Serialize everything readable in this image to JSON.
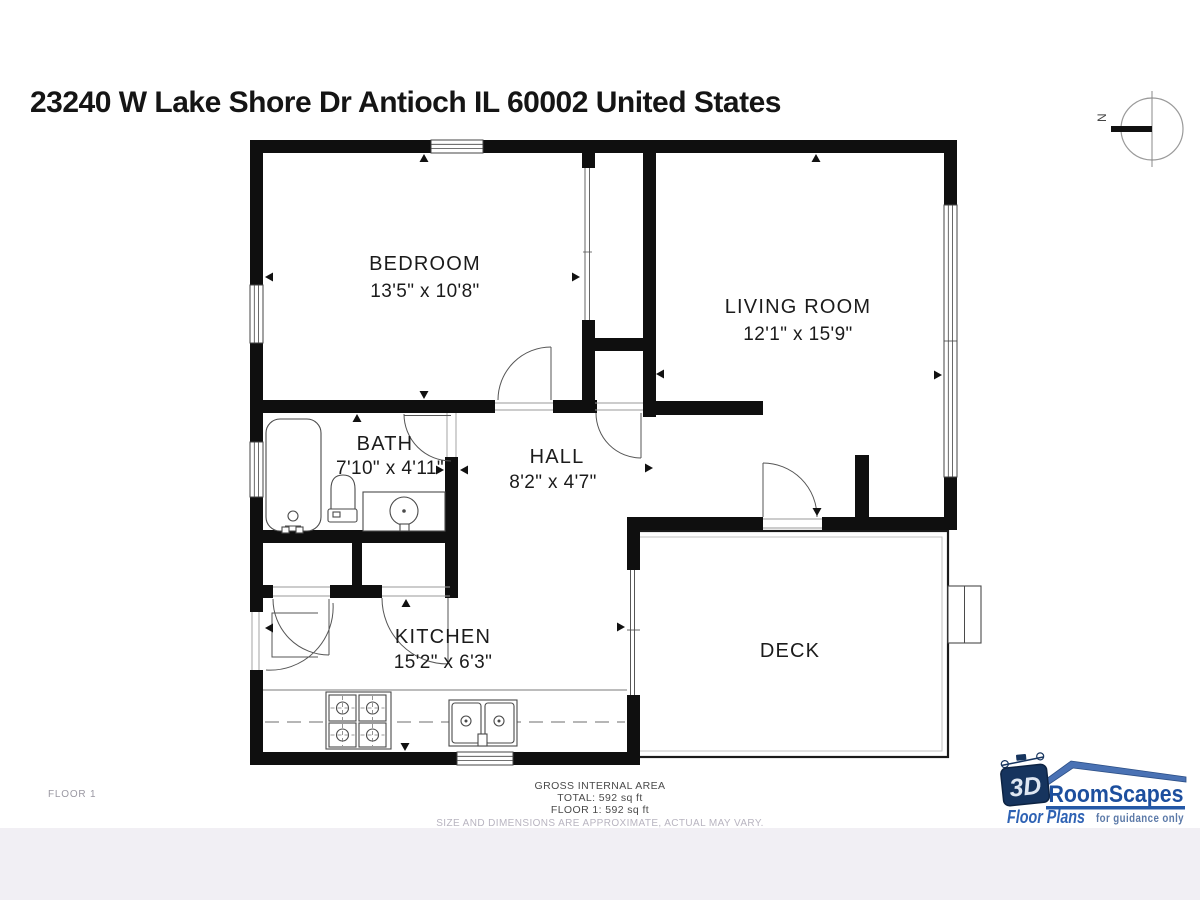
{
  "title": "23240 W Lake Shore Dr Antioch IL 60002 United States",
  "compass": {
    "north_label": "N"
  },
  "rooms": [
    {
      "name": "BEDROOM",
      "dimensions": "13'5\" x 10'8\""
    },
    {
      "name": "LIVING ROOM",
      "dimensions": "12'1\" x 15'9\""
    },
    {
      "name": "BATH",
      "dimensions": "7'10\" x 4'11\""
    },
    {
      "name": "HALL",
      "dimensions": "8'2\" x 4'7\""
    },
    {
      "name": "KITCHEN",
      "dimensions": "15'2\" x 6'3\""
    },
    {
      "name": "DECK",
      "dimensions": ""
    }
  ],
  "footer": {
    "floor_label": "FLOOR 1",
    "area_heading": "GROSS INTERNAL AREA",
    "area_total": "TOTAL: 592 sq ft",
    "area_floor": "FLOOR 1: 592 sq ft",
    "disclaimer": "SIZE AND DIMENSIONS ARE APPROXIMATE, ACTUAL MAY VARY."
  },
  "logo": {
    "brand_3d": "3D",
    "brand_name": "RoomScapes",
    "product": "Floor Plans",
    "tagline": "for guidance only",
    "brand_blue": "#2458a6",
    "brand_navy": "#16345e"
  }
}
